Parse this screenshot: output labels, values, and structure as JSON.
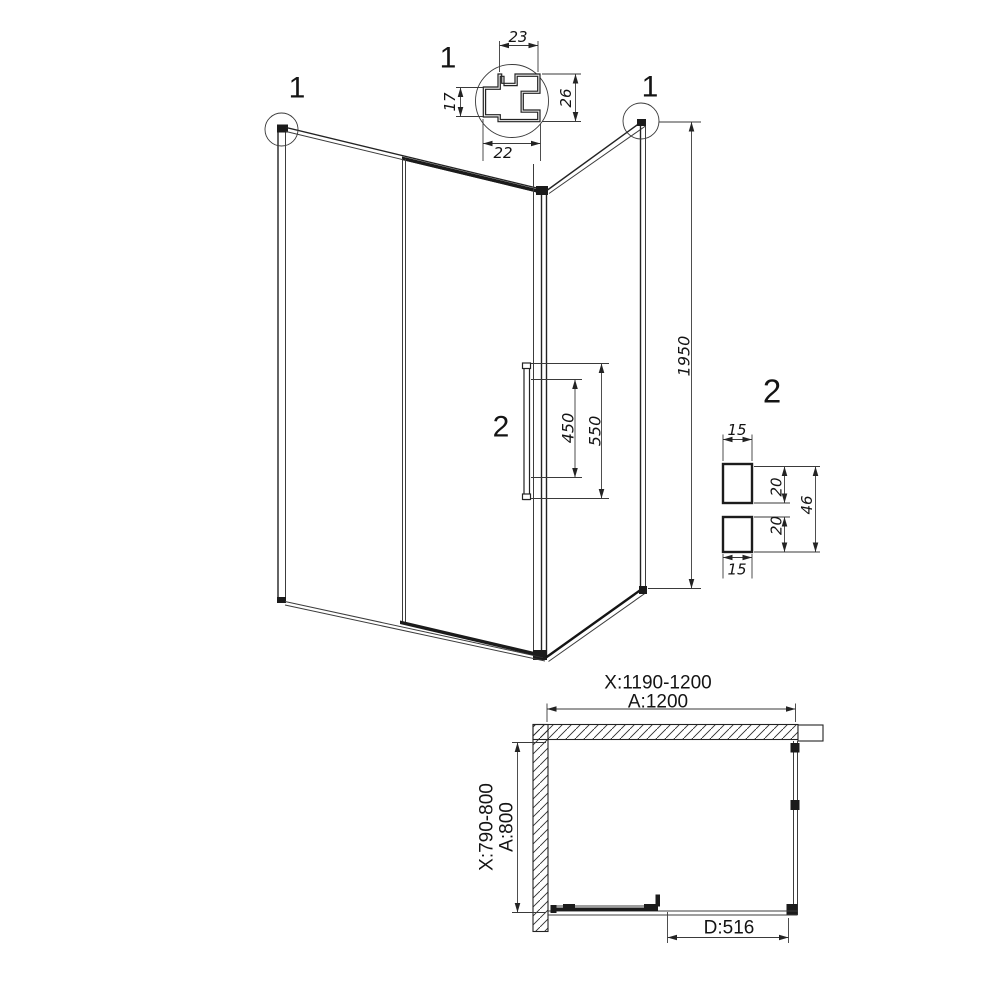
{
  "front": {
    "marker_left": "1",
    "marker_right": "1",
    "dim_height": "1950",
    "handle_marker": "2",
    "dim_handle_holes": "450",
    "dim_handle_length": "550"
  },
  "detail1": {
    "title": "1",
    "dim_top": "23",
    "dim_left": "17",
    "dim_right": "26",
    "dim_bottom": "22"
  },
  "detail2": {
    "title": "2",
    "dim_top_width": "15",
    "dim_top_depth": "20",
    "dim_overall": "46",
    "dim_bottom_depth": "20",
    "dim_bottom_width": "15"
  },
  "plan": {
    "dim_width_range": "X:1190-1200",
    "dim_width": "A:1200",
    "dim_depth_range": "X:790-800",
    "dim_depth": "A:800",
    "dim_door": "D:516"
  }
}
